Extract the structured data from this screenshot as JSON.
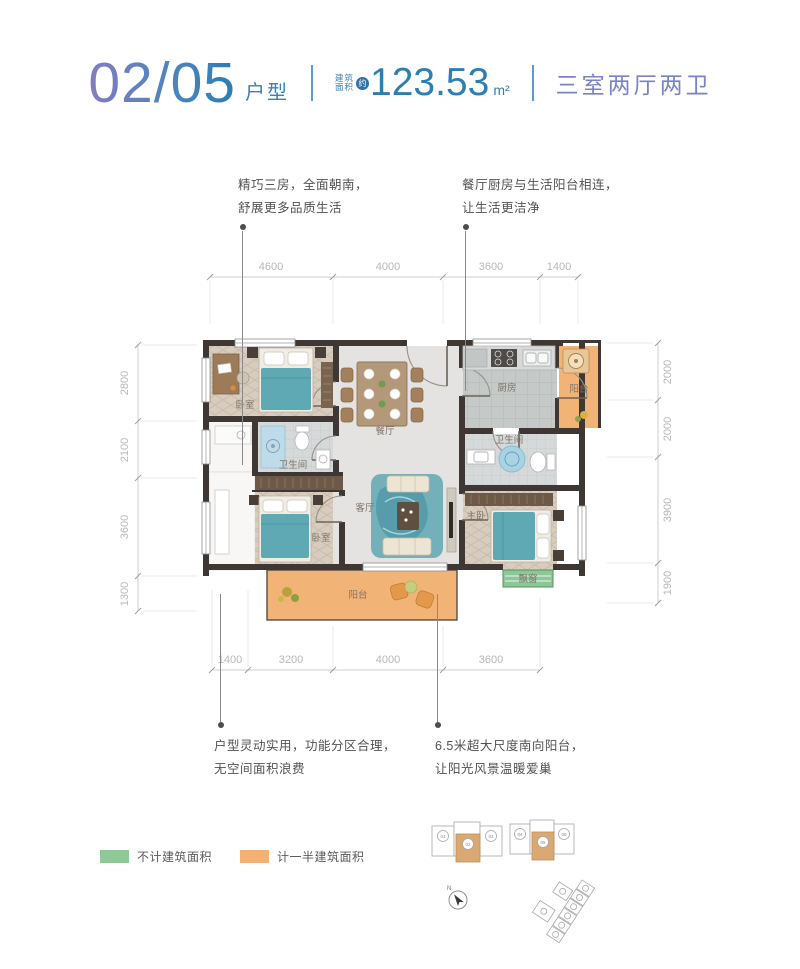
{
  "header": {
    "unit_number": "02/05",
    "unit_label": "户型",
    "area_label_top": "建筑",
    "area_label_bottom": "面积",
    "area_approx": "约",
    "area_value": "123.53",
    "area_unit": "m²",
    "rooms_summary": "三室两厅两卫"
  },
  "annotations": {
    "top_left_line1": "精巧三房，全面朝南，",
    "top_left_line2": "舒展更多品质生活",
    "top_right_line1": "餐厅厨房与生活阳台相连，",
    "top_right_line2": "让生活更洁净",
    "bottom_left_line1": "户型灵动实用，功能分区合理，",
    "bottom_left_line2": "无空间面积浪费",
    "bottom_right_line1": "6.5米超大尺度南向阳台，",
    "bottom_right_line2": "让阳光风景温暖爱巢"
  },
  "dimensions": {
    "top": [
      "4600",
      "4000",
      "3600",
      "1400"
    ],
    "bottom": [
      "1400",
      "3200",
      "4000",
      "3600"
    ],
    "left": [
      "2800",
      "2100",
      "3600",
      "1300"
    ],
    "right": [
      "2000",
      "2000",
      "3900",
      "1900"
    ]
  },
  "rooms": {
    "bedroom_top": "卧室",
    "bedroom_bottom": "卧室",
    "master_bedroom": "主卧",
    "living_room": "客厅",
    "dining_room": "餐厅",
    "kitchen": "厨房",
    "bathroom_right": "卫生间",
    "bathroom_left": "卫生间",
    "balcony_top": "阳台",
    "balcony_bottom": "阳台",
    "bay_window": "飘窗"
  },
  "legend": {
    "items": [
      {
        "label": "不计建筑面积",
        "color": "#90c998"
      },
      {
        "label": "计一半建筑面积",
        "color": "#f3b173"
      }
    ]
  },
  "key_plan": {
    "building1_units": [
      "01",
      "02",
      "03"
    ],
    "building2_units": [
      "04",
      "05",
      "06"
    ],
    "compass": "N"
  },
  "colors": {
    "title_gradient_start": "#837cc0",
    "title_gradient_end": "#2e7cb5",
    "title_blue": "#3a80b8",
    "summary_purple": "#7a83c5",
    "half_area_orange": "#f3b173",
    "no_area_green": "#90c998",
    "wall_dark": "#3e3734",
    "bed_teal": "#5ea9b4"
  }
}
